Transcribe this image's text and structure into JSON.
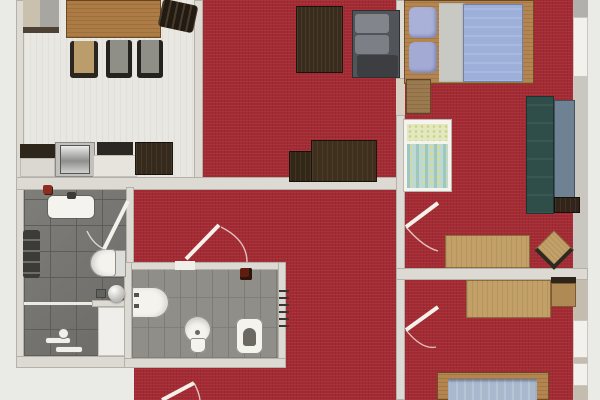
{
  "app": {
    "type": "architectural-floor-plan",
    "description": "Top-down rendered floor plan of an apartment with red carpeted rooms, tiled bathrooms and a white kitchen-dining area",
    "visible_text": []
  },
  "palette": {
    "carpet": "#a42a33",
    "exterior": "#eaebe6",
    "wall": "#dcdad3",
    "wall-shadow": "#b3b1aa",
    "kitchen-floor": "#e9e7e1",
    "tile-dark": "#757470",
    "tile-grout": "#5e5d58",
    "tile-mid": "#8f8e88",
    "plank-line": "#7c7b75",
    "wood": "#b5854f",
    "wood-light": "#c2a067",
    "wood-dark": "#8a6535",
    "dark-furniture": "#3a2c1c",
    "charcoal": "#45474a",
    "sofa-cushion": "#82858c",
    "teal-back": "#2f4e4a",
    "teal-seat": "#6e8293",
    "mattress-blue": "#9db0d9",
    "mattress-blue2": "#a9b8cc",
    "pillow-lilac": "#a9b1d9",
    "blanket-gray": "#c9c9c4",
    "white-fixture": "#f4f3ee",
    "steel": "#a8a8a6",
    "crib-green": "#bedad0",
    "crib-yellow": "#e3e8c2",
    "door-line": "#f4f1ea",
    "accent-red-item": "#8d2c20",
    "window": "#f2f1ec",
    "wall-outer": "#cac7c0"
  },
  "rooms": [
    {
      "id": "kitchen-dining",
      "label": "kitchen and dining room",
      "floor": "light stripes"
    },
    {
      "id": "living-room",
      "label": "living room",
      "floor": "red carpet"
    },
    {
      "id": "hallway",
      "label": "central hallway room",
      "floor": "red carpet"
    },
    {
      "id": "bathroom",
      "label": "main bathroom",
      "floor": "dark gray tile"
    },
    {
      "id": "wc-bathroom",
      "label": "inner WC bathroom",
      "floor": "gray tile"
    },
    {
      "id": "bedroom-1",
      "label": "top right bedroom",
      "floor": "red carpet"
    },
    {
      "id": "bedroom-2",
      "label": "bottom right bedroom",
      "floor": "red carpet"
    },
    {
      "id": "storage-niche",
      "label": "small storage niche",
      "floor": "white"
    }
  ],
  "furniture": [
    {
      "id": "dining-table",
      "room": "kitchen-dining"
    },
    {
      "id": "dining-chairs",
      "room": "kitchen-dining",
      "count": 4
    },
    {
      "id": "kitchen-counter-sink-cooktop",
      "room": "kitchen-dining"
    },
    {
      "id": "sideboard",
      "room": "kitchen-dining"
    },
    {
      "id": "dark-wood-table",
      "room": "living-room"
    },
    {
      "id": "gray-sofa",
      "room": "living-room"
    },
    {
      "id": "tv-cabinet",
      "room": "living-room"
    },
    {
      "id": "double-bed",
      "room": "bedroom-1"
    },
    {
      "id": "baby-crib",
      "room": "bedroom-1"
    },
    {
      "id": "teal-sofa",
      "room": "bedroom-1"
    },
    {
      "id": "side-table",
      "room": "bedroom-1"
    },
    {
      "id": "desk",
      "room": "bedroom-1"
    },
    {
      "id": "stool",
      "room": "bedroom-1"
    },
    {
      "id": "desk",
      "room": "bedroom-2"
    },
    {
      "id": "chair",
      "room": "bedroom-2"
    },
    {
      "id": "single-bed",
      "room": "bedroom-2"
    }
  ],
  "fixtures": [
    {
      "id": "washbasin",
      "room": "bathroom"
    },
    {
      "id": "towel-radiator",
      "room": "bathroom"
    },
    {
      "id": "wall-hung-toilet",
      "room": "bathroom"
    },
    {
      "id": "shower",
      "room": "bathroom"
    },
    {
      "id": "bathtub-basin",
      "room": "wc-bathroom"
    },
    {
      "id": "toilet",
      "room": "wc-bathroom"
    },
    {
      "id": "bidet",
      "room": "wc-bathroom"
    },
    {
      "id": "radiator",
      "room": "wc-bathroom"
    }
  ],
  "doors": [
    {
      "id": "bathroom-door",
      "between": [
        "hallway",
        "bathroom"
      ]
    },
    {
      "id": "wc-door",
      "between": [
        "hallway",
        "wc-bathroom"
      ]
    },
    {
      "id": "bedroom1-door",
      "between": [
        "hallway",
        "bedroom-1"
      ]
    },
    {
      "id": "bedroom2-door",
      "between": [
        "hallway",
        "bedroom-2"
      ]
    },
    {
      "id": "living-bedroom1-door",
      "between": [
        "living-room",
        "bedroom-1"
      ]
    },
    {
      "id": "bottom-door",
      "between": [
        "hallway",
        "outside"
      ]
    }
  ]
}
